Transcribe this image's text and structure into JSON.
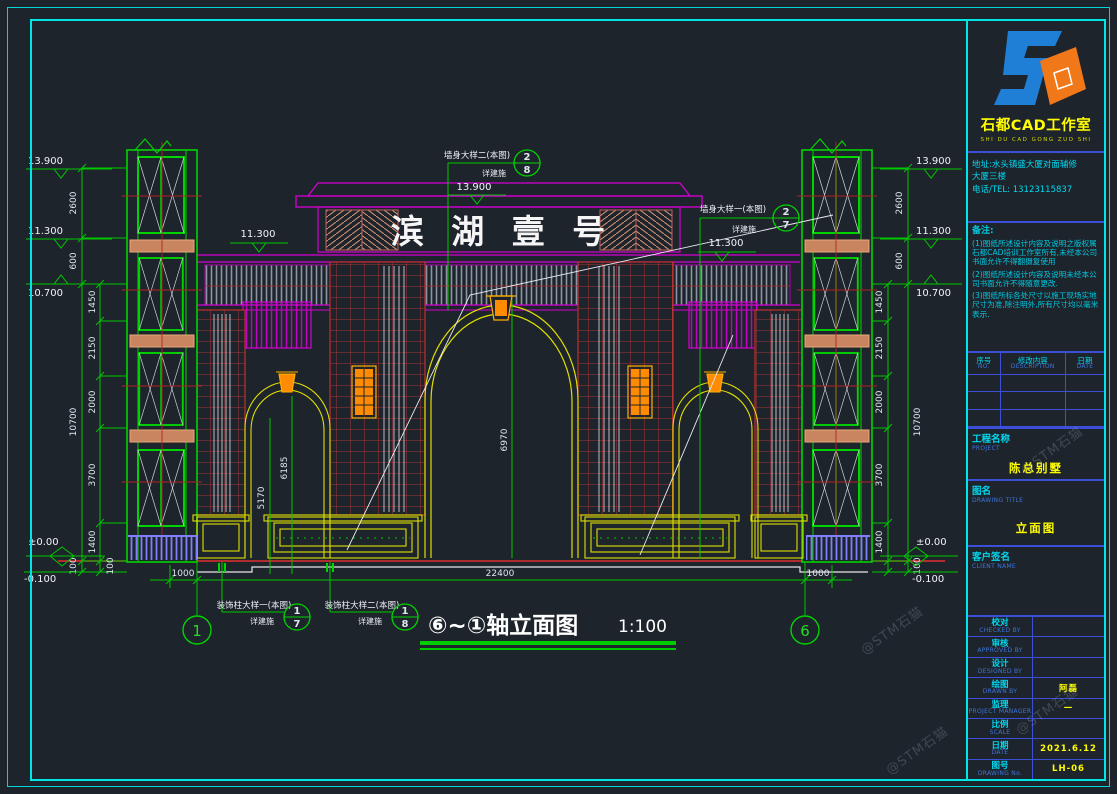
{
  "drawing": {
    "sign_text": "滨 湖 壹 号",
    "view_title": "⑥~①轴立面图",
    "view_scale": "1:100",
    "levels": [
      "13.900",
      "11.300",
      "10.700",
      "±0.00",
      "-0.100"
    ],
    "dims_outer": [
      "2600",
      "600",
      "10700",
      "100"
    ],
    "dims_inner": [
      "1450",
      "2150",
      "2000",
      "3700",
      "1400",
      "100"
    ],
    "dims_bottom": [
      "1000",
      "22400",
      "1000"
    ],
    "dims_interior": [
      "5170",
      "6185",
      "6970"
    ],
    "axis_left": "1",
    "axis_right": "6",
    "callouts": [
      {
        "label": "墙身大样二(本图)",
        "sub": "详建施",
        "num": "2",
        "den": "8"
      },
      {
        "label": "墙身大样一(本图)",
        "sub": "详建施",
        "num": "2",
        "den": "7"
      },
      {
        "label": "装饰柱大样一(本图)",
        "sub": "详建施",
        "num": "1",
        "den": "7"
      },
      {
        "label": "装饰柱大样二(本图)",
        "sub": "详建施",
        "num": "1",
        "den": "8"
      }
    ]
  },
  "title_block": {
    "studio_name": "石都CAD工作室",
    "studio_pinyin": "SHI DU CAD GONG ZUO SHI",
    "address_line1": "地址:水头镇盛大厦对面辅修",
    "address_line2": "大厦三楼",
    "phone": "电话/TEL: 13123115837",
    "notes_title": "备注:",
    "notes": [
      "(1)图纸所述设计内容及说明之版权属石都CAD培训工作室所有,未经本公司书面允许不得翻摄复使用",
      "(2)图纸所述设计内容及说明未经本公司书面允许不得随意更改.",
      "(3)图纸所标各处尺寸以施工现场实地尺寸为准,除注明外,所有尺寸均以毫米表示."
    ],
    "rev_headers": [
      {
        "cn": "序号",
        "en": "NO."
      },
      {
        "cn": "修改内容",
        "en": "DESCRIPTION"
      },
      {
        "cn": "日期",
        "en": "DATE"
      }
    ],
    "project": {
      "cn": "工程名称",
      "en": "PROJECT",
      "value": "陈总别墅"
    },
    "drawing_name": {
      "cn": "图名",
      "en": "DRAWING TITLE",
      "value": "立面图"
    },
    "client": {
      "cn": "客户签名",
      "en": "CLIENT NAME",
      "value": ""
    },
    "fields": [
      {
        "cn": "校对",
        "en": "CHECKED BY",
        "value": ""
      },
      {
        "cn": "审核",
        "en": "APPROVED BY",
        "value": ""
      },
      {
        "cn": "设计",
        "en": "DESIGNED BY",
        "value": ""
      },
      {
        "cn": "绘图",
        "en": "DRAWN BY",
        "value": "阿磊"
      },
      {
        "cn": "监理",
        "en": "PROJECT MANAGER",
        "value": "—"
      },
      {
        "cn": "比例",
        "en": "SCALE",
        "value": ""
      },
      {
        "cn": "日期",
        "en": "DATE",
        "value": "2021.6.12"
      },
      {
        "cn": "图号",
        "en": "DRAWING No.",
        "value": "LH-06"
      }
    ],
    "watermark": "@STM石猫"
  },
  "colors": {
    "background": "#1e242c",
    "frame_cyan": "#00e5e5",
    "cad_green": "#00d400",
    "cad_magenta": "#e800e8",
    "cad_yellow": "#e8e800",
    "cad_red": "#c83232",
    "cad_orange": "#ff8c00",
    "fence_blue": "#8080ff",
    "logo_blue": "#1f7fd6",
    "logo_orange": "#f07818",
    "label_cyan": "#00d8f0",
    "value_yellow": "#ffff00"
  }
}
